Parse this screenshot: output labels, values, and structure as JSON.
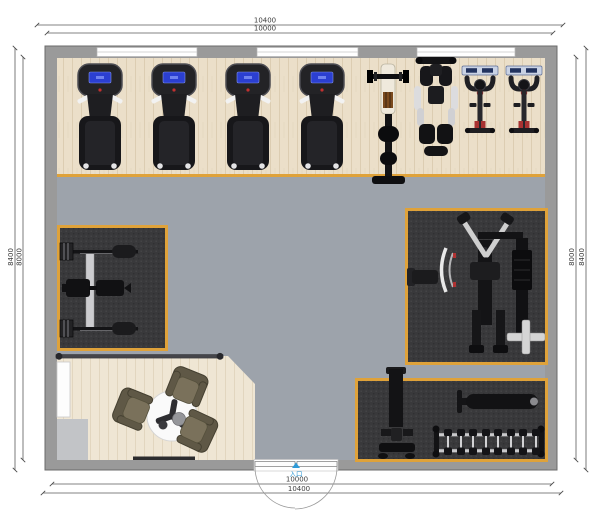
{
  "dimensions": {
    "top_outer": "10400",
    "top_inner": "10000",
    "bottom_inner": "10000",
    "bottom_outer": "10400",
    "left_outer": "8400",
    "left_inner": "8000",
    "right_inner": "8000",
    "right_outer": "8400"
  },
  "entrance": {
    "label": "入口"
  },
  "colors": {
    "wall": "#9a9a9a",
    "wood_floor": "#ebdfc9",
    "reception_floor": "#efe6d4",
    "gym_floor": "#9da3ab",
    "carpet": "#39393b",
    "carpet_border": "#dfa23a",
    "equipment_black": "#1a1a1c",
    "screen_blue": "#2b3fd1",
    "accent_red": "#b03232",
    "entrance_accent": "#2f9bd8"
  },
  "equipment": {
    "treadmill_count": 4,
    "spin_bike_count": 2,
    "dumbbell_count": 8,
    "chair_count": 3,
    "items": [
      "treadmill",
      "barbell-bench-rack",
      "shoulder-press-machine",
      "spin-bike",
      "bench-press-station",
      "multi-gym-station",
      "lat-pulldown-machine",
      "flat-bench",
      "dumbbell-rack",
      "reception-table",
      "lounge-chair",
      "reception-counter"
    ]
  }
}
